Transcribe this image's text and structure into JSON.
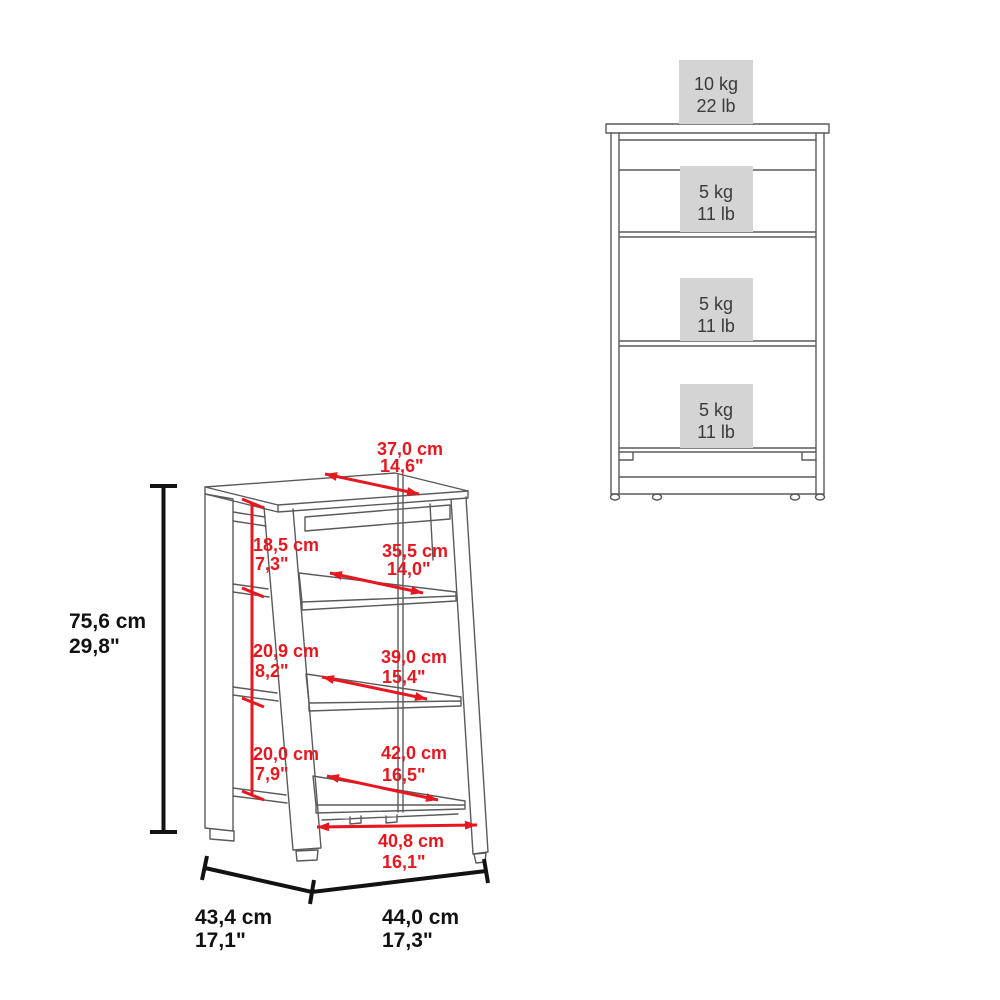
{
  "colors": {
    "line": "#5a5a5a",
    "red": "#e8171f",
    "black": "#121212",
    "capacity_box": "#d4d4d4",
    "box_text": "#3a3a3a"
  },
  "perspective_view": {
    "top_depth": {
      "cm": "37,0 cm",
      "in": "14,6\""
    },
    "height": {
      "cm": "75,6 cm",
      "in": "29,8\""
    },
    "compartments": [
      {
        "height_cm": "18,5 cm",
        "height_in": "7,3\"",
        "depth_cm": "35,5 cm",
        "depth_in": "14,0\""
      },
      {
        "height_cm": "20,9 cm",
        "height_in": "8,2\"",
        "depth_cm": "39,0 cm",
        "depth_in": "15,4\""
      },
      {
        "height_cm": "20,0 cm",
        "height_in": "7,9\"",
        "depth_cm": "42,0 cm",
        "depth_in": "16,5\""
      }
    ],
    "base_width": {
      "cm": "40,8 cm",
      "in": "16,1\""
    },
    "depth": {
      "cm": "43,4 cm",
      "in": "17,1\""
    },
    "width": {
      "cm": "44,0 cm",
      "in": "17,3\""
    }
  },
  "front_view": {
    "top_capacity": {
      "kg": "10 kg",
      "lb": "22 lb"
    },
    "shelf_capacities": [
      {
        "kg": "5 kg",
        "lb": "11 lb"
      },
      {
        "kg": "5 kg",
        "lb": "11 lb"
      },
      {
        "kg": "5 kg",
        "lb": "11 lb"
      }
    ]
  }
}
